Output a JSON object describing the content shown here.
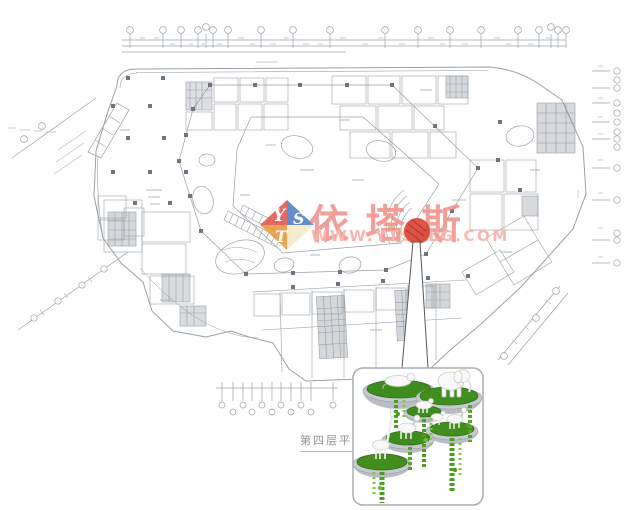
{
  "page": {
    "background": "#ffffff"
  },
  "watermark": {
    "brand": "依塔斯",
    "url": "WWW.YTSBLG.COM",
    "logo_letters": {
      "top_left": "Y",
      "top_right": "S",
      "bottom": "T"
    },
    "colors": {
      "brand_pink": "#f08a82",
      "url_pink": "#f8b2ac",
      "logo_red": "#e2574d",
      "logo_blue": "#4d7fc4",
      "logo_orange": "#e89a3c",
      "logo_cream": "#f5e9c9"
    }
  },
  "caption": {
    "text": "第四层平面",
    "color": "#8f9496"
  },
  "marker": {
    "color": "#d8473a"
  },
  "detail_inset": {
    "subject": "hanging planter discs with white animal sculptures and trailing vines",
    "animals": [
      "elephant",
      "giraffe",
      "deer",
      "horse",
      "goat"
    ],
    "colors": {
      "grass": "#3f8c1e",
      "vine_dark": "#4e9e22",
      "vine_light": "#83c943",
      "rim": "#b9bdc3",
      "animal": "#f8f9f7"
    }
  },
  "plan": {
    "line_color": "#9aa0a6",
    "column_color": "#6e757c"
  }
}
